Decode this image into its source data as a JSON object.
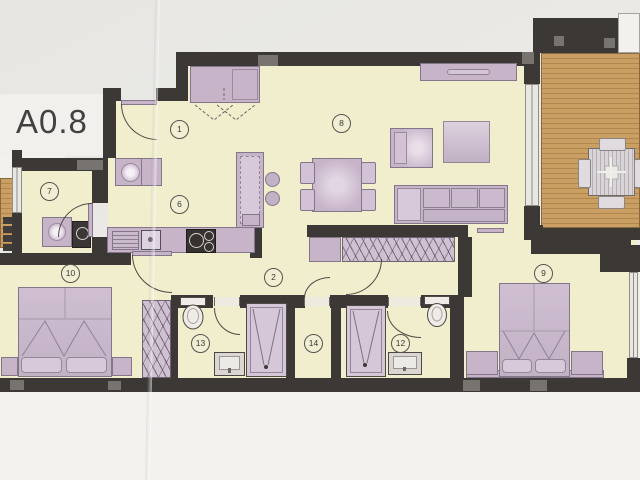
{
  "document": {
    "sheet_label": "A0.8",
    "type": "apartment-floor-plan"
  },
  "room_labels": {
    "entrance": "1",
    "corridor": "2",
    "kitchen": "6",
    "utility": "7",
    "living": "8",
    "bedroom2": "9",
    "bedroom1": "10",
    "bathroom2": "12",
    "bathroom1": "13",
    "inner_hall": "14"
  },
  "colors": {
    "walls": "#3b3835",
    "room_fill": "#f0eecd",
    "furniture": "#c7b4c9",
    "wood_deck": "#c99f63",
    "paper": "#ebeae6"
  },
  "furniture_icons": [
    "double-bed",
    "wardrobe",
    "shower",
    "toilet",
    "washbasin-vanity",
    "sofa",
    "armchair",
    "dining-table",
    "bar-stool",
    "kitchen-island",
    "kitchen-hob",
    "kitchen-sink",
    "washing-machine",
    "tv-sideboard",
    "outdoor-dining-table",
    "entry-closet",
    "balcony-deck"
  ]
}
